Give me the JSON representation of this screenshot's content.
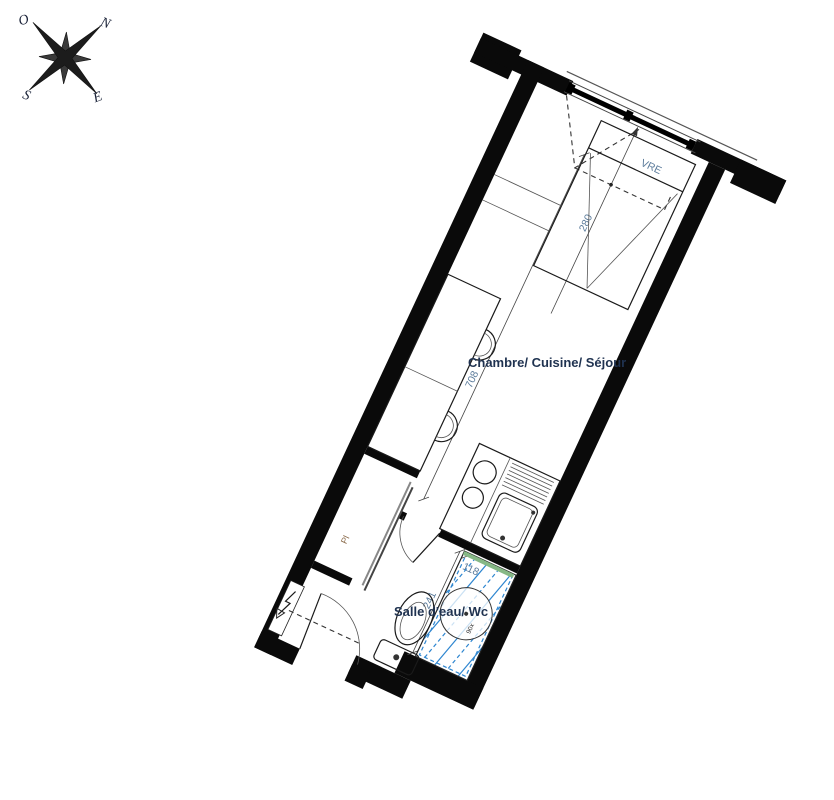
{
  "compass": {
    "labels": {
      "o": "O",
      "n": "N",
      "s": "S",
      "e": "E"
    }
  },
  "plan": {
    "labels": {
      "main_room": "Chambre/ Cuisine/ Séjour",
      "bathroom": "Salle d'eau/ Wc",
      "window": "VRE",
      "closet": "Pl",
      "shower": "90x"
    },
    "dimensions": {
      "room_width_cm": "280",
      "room_length_cm": "708",
      "bathroom_length_cm": "241",
      "shower_width_cm": "118"
    },
    "colors": {
      "wall": "#0a0a0a",
      "shower_hatch": "#2e86d0",
      "glass_screen": "#86b886",
      "dimension_text": "#5a7a9a",
      "room_label_text": "#1f3250"
    }
  }
}
